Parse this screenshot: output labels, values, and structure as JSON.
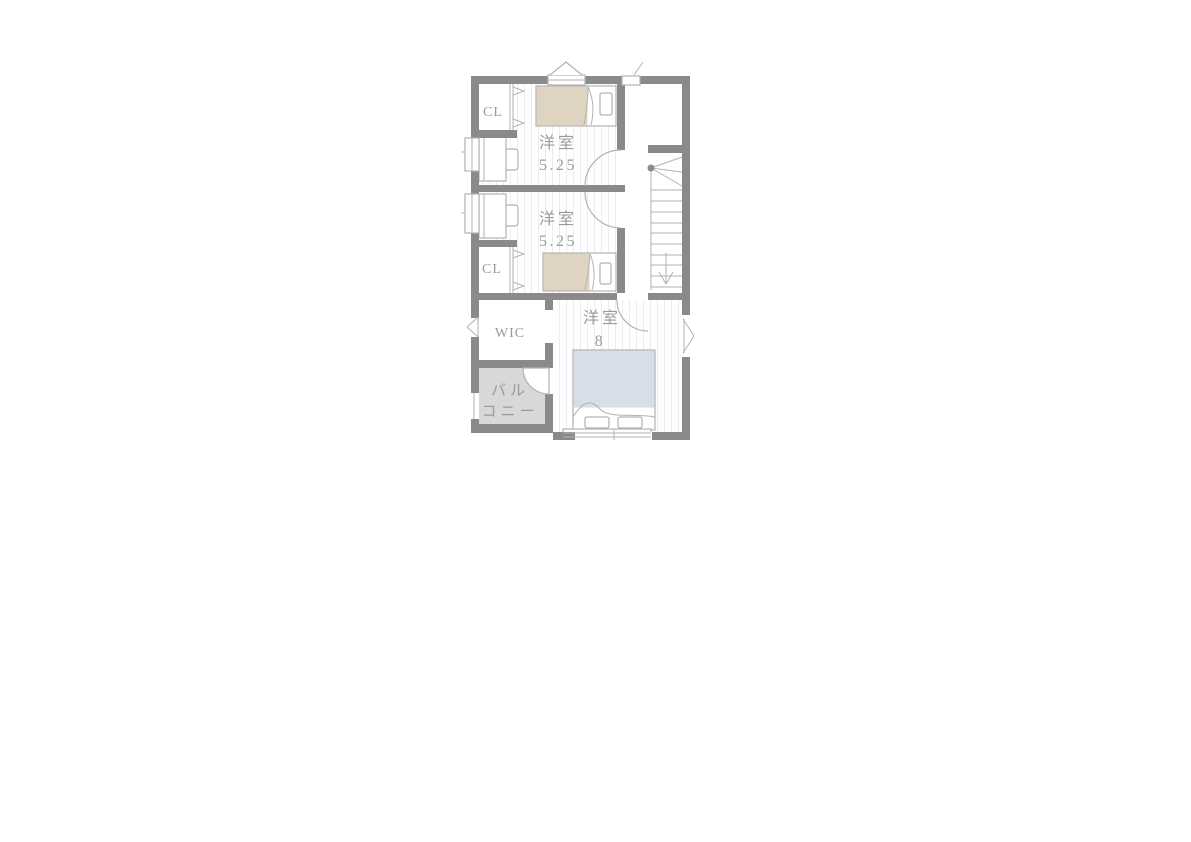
{
  "floor_plan": {
    "rooms": [
      {
        "id": "closet-1",
        "label": "CL"
      },
      {
        "id": "bedroom-1",
        "name": "洋室",
        "size": "5.25"
      },
      {
        "id": "bedroom-2",
        "name": "洋室",
        "size": "5.25"
      },
      {
        "id": "closet-2",
        "label": "CL"
      },
      {
        "id": "wic",
        "label": "WIC"
      },
      {
        "id": "master-bedroom",
        "name": "洋室",
        "size": "8"
      },
      {
        "id": "balcony",
        "label_line1": "バル",
        "label_line2": "コニー"
      }
    ],
    "colors": {
      "wall": "#8a8a8a",
      "floor_line": "#ebebf1",
      "bed_single": "#ded4c1",
      "bed_double": "#d6dee8",
      "balcony": "#d8d8d8",
      "outline": "#b2b2b2",
      "text": "#9b9b9b"
    }
  }
}
